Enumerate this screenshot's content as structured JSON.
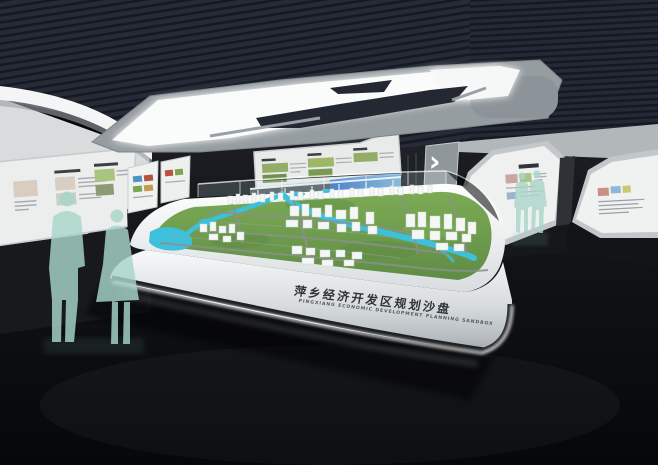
{
  "scene": {
    "sandtable": {
      "title_cn": "萍乡经济开发区规划沙盘",
      "title_en": "PINGXIANG ECONOMIC DEVELOPMENT PLANNING SANDBOX"
    },
    "signage": {
      "chevron_right": "›"
    },
    "palette": {
      "ceiling": "#262b37",
      "floor": "#0b0c10",
      "wall_panels": "#eceeee",
      "light_fixture": "#fafcfc",
      "terrain_green": "#6f9e4d",
      "water_cyan": "#3cc0dc",
      "model_buildings": "#f5f7f6",
      "visitor_figures": "#a9d6c9",
      "accent_blue": "#2f6fd0"
    }
  }
}
